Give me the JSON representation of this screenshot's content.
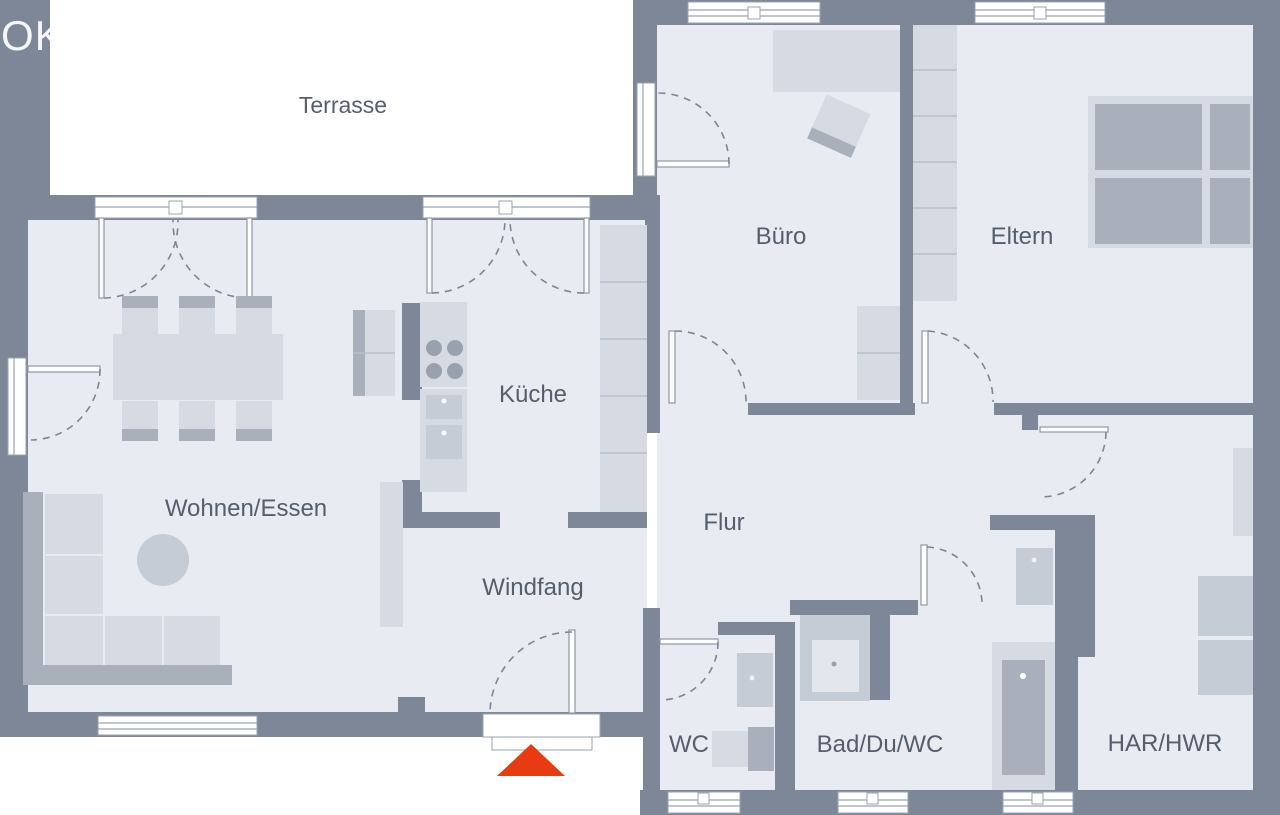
{
  "plan": {
    "type": "floor-plan",
    "watermarks": {
      "top_left": "OK",
      "top_center": "t"
    },
    "rooms": [
      {
        "id": "terrasse",
        "label": "Terrasse"
      },
      {
        "id": "buero",
        "label": "Büro"
      },
      {
        "id": "eltern",
        "label": "Eltern"
      },
      {
        "id": "kueche",
        "label": "Küche"
      },
      {
        "id": "wohnen-essen",
        "label": "Wohnen/Essen"
      },
      {
        "id": "flur",
        "label": "Flur"
      },
      {
        "id": "windfang",
        "label": "Windfang"
      },
      {
        "id": "wc",
        "label": "WC"
      },
      {
        "id": "bad-du-wc",
        "label": "Bad/Du/WC"
      },
      {
        "id": "har-hwr",
        "label": "HAR/HWR"
      }
    ],
    "entrance_marker": {
      "icon": "entrance-arrow-icon",
      "shape": "triangle",
      "color": "#e73c11"
    },
    "colors": {
      "background": "#ffffff",
      "wall": "#7d8798",
      "floor": "#e8ebf1",
      "furniture_light": "#d6dae2",
      "furniture_mid": "#c6ccd5",
      "furniture_dark": "#a9b0bc",
      "label_text": "#555e6c",
      "entrance_arrow": "#e73c11",
      "watermark": "#ffffff"
    },
    "furniture_icons": [
      "dining-table",
      "dining-chair",
      "corner-sofa",
      "side-table",
      "sideboard",
      "kitchen-stove",
      "kitchen-sink",
      "dishwasher",
      "fridge-unit",
      "tall-cabinet",
      "desk",
      "office-chair",
      "office-cabinet",
      "wardrobe",
      "double-bed",
      "washbasin",
      "toilet",
      "shower",
      "bathtub",
      "washing-machine",
      "dryer",
      "shelf"
    ]
  }
}
